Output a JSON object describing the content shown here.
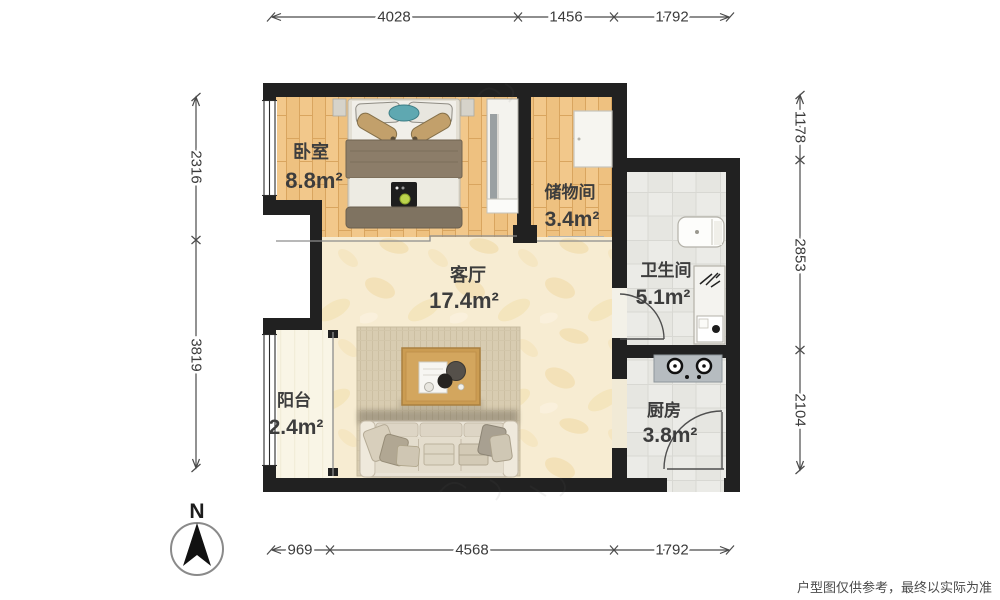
{
  "title": "floor-plan",
  "rooms": {
    "bedroom": {
      "name": "卧室",
      "area": "8.8m²"
    },
    "storage": {
      "name": "储物间",
      "area": "3.4m²"
    },
    "bathroom": {
      "name": "卫生间",
      "area": "5.1m²"
    },
    "living": {
      "name": "客厅",
      "area": "17.4m²"
    },
    "balcony": {
      "name": "阳台",
      "area": "2.4m²"
    },
    "kitchen": {
      "name": "厨房",
      "area": "3.8m²"
    }
  },
  "dimensions": {
    "top": [
      "4028",
      "1456",
      "1792"
    ],
    "bottom": [
      "969",
      "4568",
      "1792"
    ],
    "left": [
      "2316",
      "3819"
    ],
    "right": [
      "1178",
      "2853",
      "2104"
    ]
  },
  "compass": {
    "label": "N"
  },
  "footer": {
    "disclaimer": "户型图仅供参考，最终以实际为准"
  },
  "colors": {
    "wall": "#212121",
    "wood_floor": "#eec180",
    "wood_joint": "#d9a55f",
    "marble_floor": "#f7ecd2",
    "marble_vein": "#f0d9a2",
    "tile_floor": "#ebebe7",
    "tile_line": "#d8d8d3",
    "balcony_floor": "#f9f5e6",
    "rug": "#d8ccb1",
    "table_wood": "#cb9c52",
    "sofa": "#e9e3d6",
    "bed_blanket": "#8c7d69",
    "pillow_tan": "#c2a06b",
    "accent_teal": "#5fa8b1",
    "stove_gray": "#b6bcc0",
    "speaker_green": "#bcd44d",
    "dim_text": "#3a3a3a"
  }
}
